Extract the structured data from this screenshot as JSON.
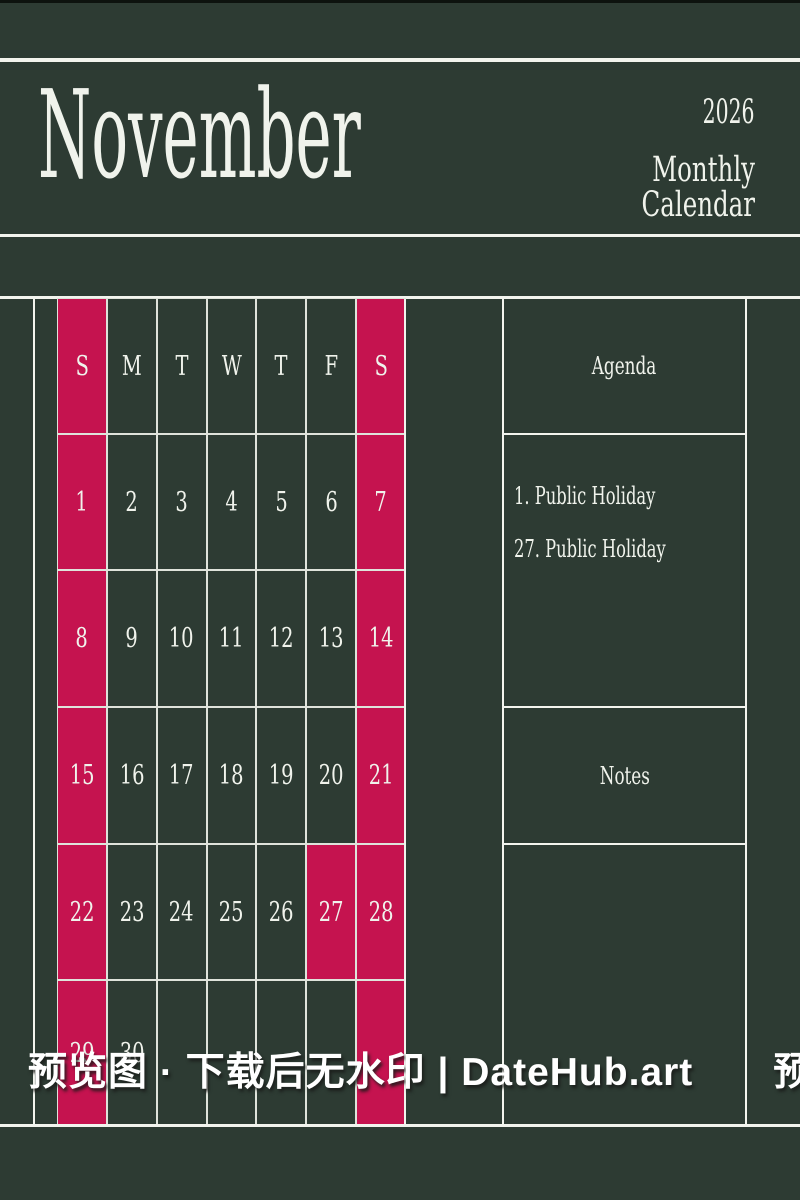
{
  "page": {
    "bg_color": "#2d3b33",
    "line_color": "#f2f4ee",
    "grid_line_color": "#dfe3db",
    "ink_color": "#f0f3ec",
    "accent_color": "#c5134f"
  },
  "header": {
    "month": "November",
    "year": "2026",
    "subtitle": "Monthly Calendar"
  },
  "calendar": {
    "weekday_headers": [
      "S",
      "M",
      "T",
      "W",
      "T",
      "F",
      "S"
    ],
    "weeks": [
      [
        "1",
        "2",
        "3",
        "4",
        "5",
        "6",
        "7"
      ],
      [
        "8",
        "9",
        "10",
        "11",
        "12",
        "13",
        "14"
      ],
      [
        "15",
        "16",
        "17",
        "18",
        "19",
        "20",
        "21"
      ],
      [
        "22",
        "23",
        "24",
        "25",
        "26",
        "27",
        "28"
      ],
      [
        "29",
        "30",
        "",
        "",
        "",
        "",
        ""
      ]
    ],
    "highlight_columns": [
      0,
      6
    ],
    "highlight_cells": [
      {
        "week": 3,
        "day_col": 5,
        "day": "27"
      }
    ],
    "highlight_color": "#c5134f"
  },
  "agenda": {
    "title": "Agenda",
    "items": [
      "1. Public Holiday",
      "27. Public Holiday"
    ]
  },
  "notes": {
    "title": "Notes"
  },
  "watermark": {
    "text": "预览图 · 下载后无水印 | DateHub.art　　预览图 ·"
  }
}
